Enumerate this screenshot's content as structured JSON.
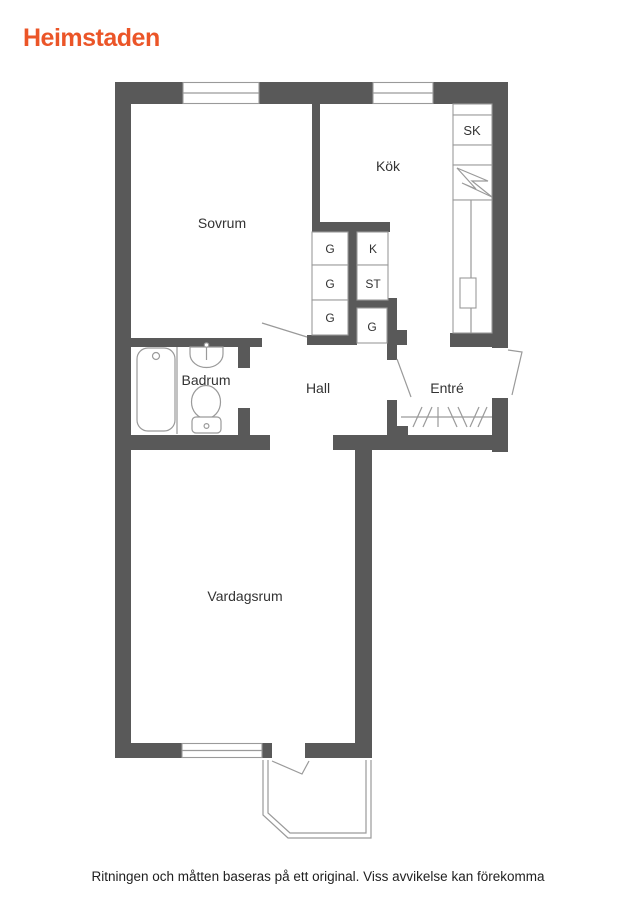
{
  "logo": {
    "text": "Heimstaden",
    "color": "#eb5528"
  },
  "disclaimer": "Ritningen och måtten baseras på ett original. Viss avvikelse kan förekomma",
  "floor_plan": {
    "rooms": {
      "sovrum": {
        "label": "Sovrum"
      },
      "kok": {
        "label": "Kök"
      },
      "badrum": {
        "label": "Badrum"
      },
      "hall": {
        "label": "Hall"
      },
      "entre": {
        "label": "Entré"
      },
      "vardagsrum": {
        "label": "Vardagsrum"
      }
    },
    "closets": {
      "g1": "G",
      "g2": "G",
      "g3": "G",
      "k": "K",
      "st": "ST",
      "g4": "G",
      "sk": "SK"
    },
    "colors": {
      "wall": "#595959",
      "line": "#9a9a9a",
      "label": "#333333"
    }
  }
}
